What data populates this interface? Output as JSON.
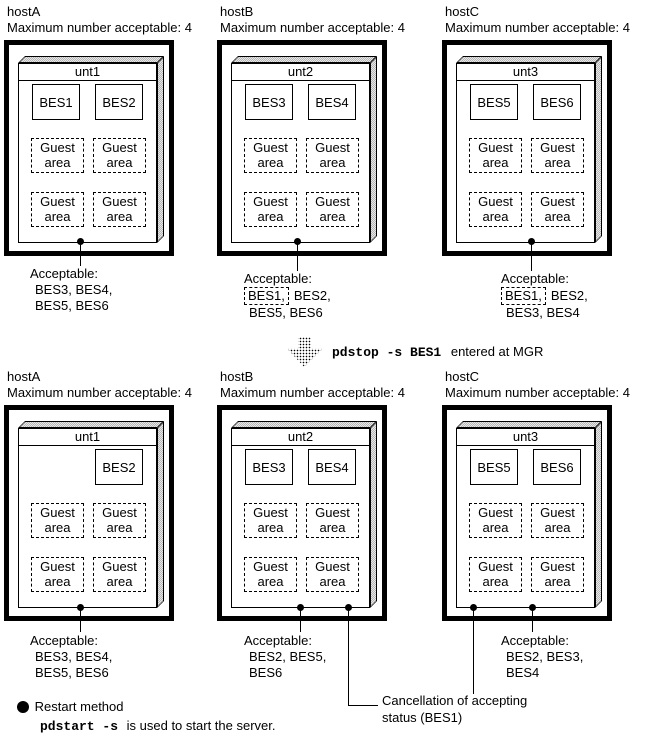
{
  "page": {
    "background": "#ffffff",
    "foreground": "#000000"
  },
  "guest_label": {
    "line1": "Guest",
    "line2": "area"
  },
  "rows": [
    {
      "id": "before",
      "hosts": [
        {
          "name": "hostA",
          "max": "Maximum number acceptable: 4",
          "unit": "unt1",
          "bes": [
            "BES1",
            "BES2"
          ],
          "acceptable": {
            "title": "Acceptable:",
            "lines": [
              [
                {
                  "t": "BES3, BES4,"
                }
              ],
              [
                {
                  "t": "BES5, BES6"
                }
              ]
            ]
          }
        },
        {
          "name": "hostB",
          "max": "Maximum number acceptable: 4",
          "unit": "unt2",
          "bes": [
            "BES3",
            "BES4"
          ],
          "acceptable": {
            "title": "Acceptable:",
            "lines": [
              [
                {
                  "t": "BES1,",
                  "boxed": true
                },
                {
                  "t": "BES2,"
                }
              ],
              [
                {
                  "t": "BES5, BES6"
                }
              ]
            ]
          }
        },
        {
          "name": "hostC",
          "max": "Maximum number acceptable: 4",
          "unit": "unt3",
          "bes": [
            "BES5",
            "BES6"
          ],
          "acceptable": {
            "title": "Acceptable:",
            "lines": [
              [
                {
                  "t": "BES1,",
                  "boxed": true
                },
                {
                  "t": "BES2,"
                }
              ],
              [
                {
                  "t": "BES3, BES4"
                }
              ]
            ]
          }
        }
      ]
    },
    {
      "id": "after",
      "hosts": [
        {
          "name": "hostA",
          "max": "Maximum number acceptable: 4",
          "unit": "unt1",
          "bes": [
            null,
            "BES2"
          ],
          "acceptable": {
            "title": "Acceptable:",
            "lines": [
              [
                {
                  "t": "BES3, BES4,"
                }
              ],
              [
                {
                  "t": "BES5, BES6"
                }
              ]
            ]
          }
        },
        {
          "name": "hostB",
          "max": "Maximum number acceptable: 4",
          "unit": "unt2",
          "bes": [
            "BES3",
            "BES4"
          ],
          "acceptable": {
            "title": "Acceptable:",
            "lines": [
              [
                {
                  "t": "BES2, BES5,"
                }
              ],
              [
                {
                  "t": "BES6"
                }
              ]
            ]
          }
        },
        {
          "name": "hostC",
          "max": "Maximum number acceptable: 4",
          "unit": "unt3",
          "bes": [
            "BES5",
            "BES6"
          ],
          "acceptable": {
            "title": "Acceptable:",
            "lines": [
              [
                {
                  "t": "BES2, BES3,"
                }
              ],
              [
                {
                  "t": "BES4"
                }
              ]
            ]
          }
        }
      ]
    }
  ],
  "command": {
    "cmd": "pdstop -s BES1",
    "suffix": "entered at MGR"
  },
  "cancellation": {
    "line1": "Cancellation of accepting",
    "line2": "status (BES1)"
  },
  "restart": {
    "title": "Restart method",
    "cmd": "pdstart -s",
    "rest": "is used to start the server."
  }
}
